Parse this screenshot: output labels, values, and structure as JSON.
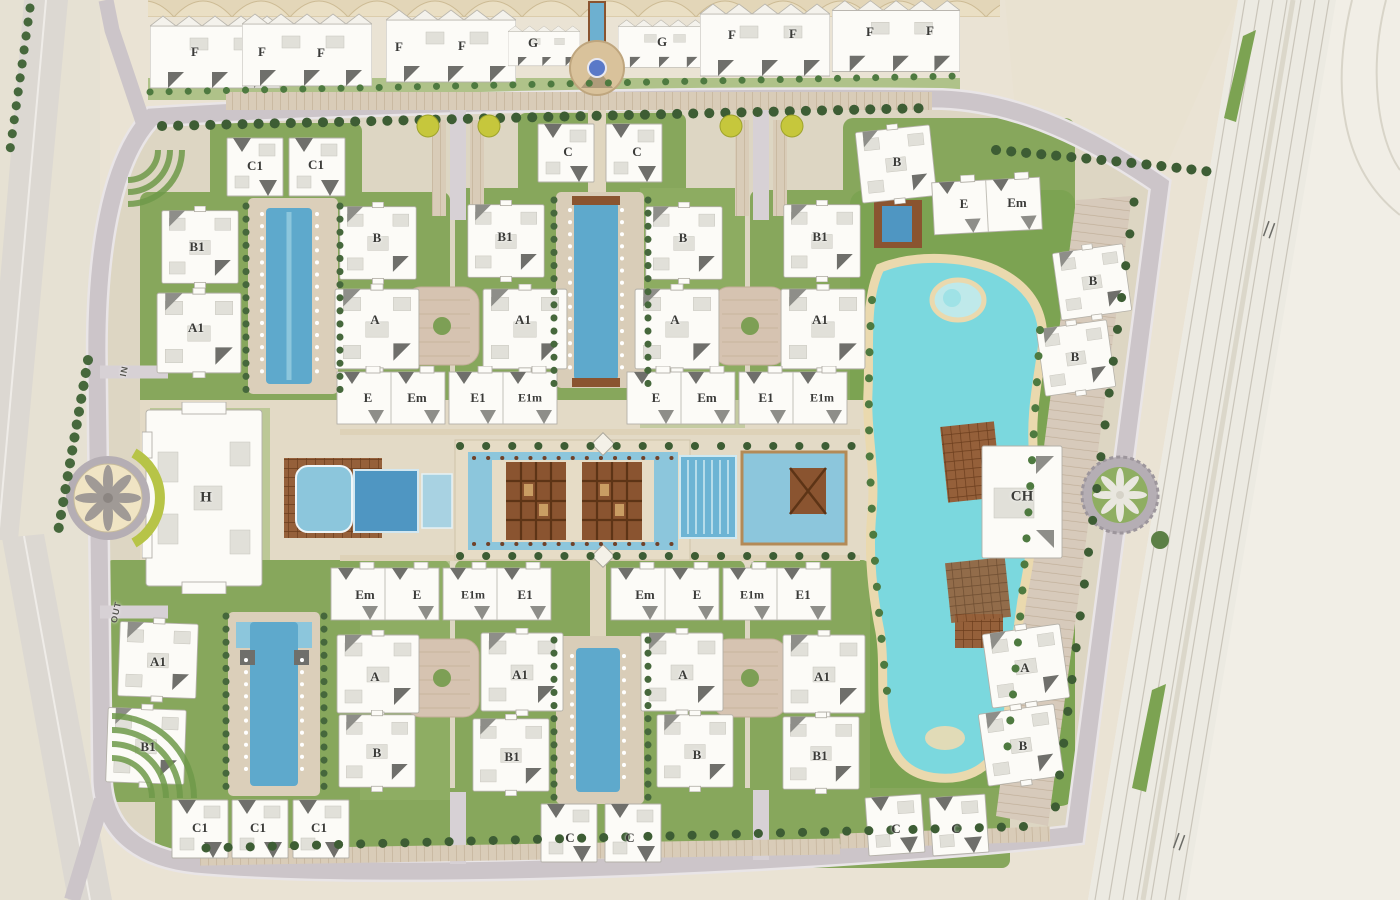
{
  "map": {
    "type": "residential-compound-master-plan",
    "building_labels": [
      {
        "text": "F",
        "x": 195,
        "y": 52
      },
      {
        "text": "F",
        "x": 262,
        "y": 52
      },
      {
        "text": "F",
        "x": 321,
        "y": 53
      },
      {
        "text": "F",
        "x": 399,
        "y": 47
      },
      {
        "text": "F",
        "x": 462,
        "y": 46
      },
      {
        "text": "G",
        "x": 533,
        "y": 43
      },
      {
        "text": "G",
        "x": 662,
        "y": 42
      },
      {
        "text": "F",
        "x": 732,
        "y": 35
      },
      {
        "text": "F",
        "x": 793,
        "y": 34
      },
      {
        "text": "F",
        "x": 870,
        "y": 32
      },
      {
        "text": "F",
        "x": 930,
        "y": 31
      },
      {
        "text": "C1",
        "x": 255,
        "y": 166
      },
      {
        "text": "C1",
        "x": 316,
        "y": 165
      },
      {
        "text": "C",
        "x": 568,
        "y": 152
      },
      {
        "text": "C",
        "x": 637,
        "y": 152
      },
      {
        "text": "B",
        "x": 897,
        "y": 162
      },
      {
        "text": "E",
        "x": 964,
        "y": 204
      },
      {
        "text": "Em",
        "x": 1017,
        "y": 203
      },
      {
        "text": "B1",
        "x": 197,
        "y": 247
      },
      {
        "text": "B",
        "x": 377,
        "y": 238
      },
      {
        "text": "B1",
        "x": 505,
        "y": 237
      },
      {
        "text": "B",
        "x": 683,
        "y": 238
      },
      {
        "text": "B1",
        "x": 820,
        "y": 237
      },
      {
        "text": "B",
        "x": 1093,
        "y": 281
      },
      {
        "text": "A1",
        "x": 196,
        "y": 328
      },
      {
        "text": "A",
        "x": 375,
        "y": 320
      },
      {
        "text": "A1",
        "x": 523,
        "y": 320
      },
      {
        "text": "A",
        "x": 675,
        "y": 320
      },
      {
        "text": "A1",
        "x": 820,
        "y": 320
      },
      {
        "text": "B",
        "x": 1075,
        "y": 357
      },
      {
        "text": "E",
        "x": 368,
        "y": 398
      },
      {
        "text": "Em",
        "x": 417,
        "y": 398
      },
      {
        "text": "E1",
        "x": 478,
        "y": 398
      },
      {
        "text": "E1m",
        "x": 530,
        "y": 398,
        "size": 12
      },
      {
        "text": "E",
        "x": 656,
        "y": 398
      },
      {
        "text": "Em",
        "x": 707,
        "y": 398
      },
      {
        "text": "E1",
        "x": 766,
        "y": 398
      },
      {
        "text": "E1m",
        "x": 822,
        "y": 398,
        "size": 12
      },
      {
        "text": "H",
        "x": 206,
        "y": 498,
        "size": 15
      },
      {
        "text": "CH",
        "x": 1022,
        "y": 497,
        "size": 15
      },
      {
        "text": "Em",
        "x": 365,
        "y": 595
      },
      {
        "text": "E",
        "x": 417,
        "y": 595
      },
      {
        "text": "E1m",
        "x": 473,
        "y": 595,
        "size": 12
      },
      {
        "text": "E1",
        "x": 525,
        "y": 595
      },
      {
        "text": "Em",
        "x": 645,
        "y": 595
      },
      {
        "text": "E",
        "x": 697,
        "y": 595
      },
      {
        "text": "E1m",
        "x": 752,
        "y": 595,
        "size": 12
      },
      {
        "text": "E1",
        "x": 803,
        "y": 595
      },
      {
        "text": "A1",
        "x": 158,
        "y": 662
      },
      {
        "text": "A",
        "x": 375,
        "y": 677
      },
      {
        "text": "A1",
        "x": 520,
        "y": 675
      },
      {
        "text": "A",
        "x": 683,
        "y": 675
      },
      {
        "text": "A1",
        "x": 822,
        "y": 677
      },
      {
        "text": "A",
        "x": 1025,
        "y": 668
      },
      {
        "text": "B1",
        "x": 148,
        "y": 747
      },
      {
        "text": "B",
        "x": 377,
        "y": 753
      },
      {
        "text": "B1",
        "x": 512,
        "y": 757
      },
      {
        "text": "B",
        "x": 697,
        "y": 755
      },
      {
        "text": "B1",
        "x": 820,
        "y": 756
      },
      {
        "text": "B",
        "x": 1023,
        "y": 746
      },
      {
        "text": "C1",
        "x": 200,
        "y": 828
      },
      {
        "text": "C1",
        "x": 258,
        "y": 828
      },
      {
        "text": "C1",
        "x": 319,
        "y": 828
      },
      {
        "text": "C",
        "x": 570,
        "y": 838
      },
      {
        "text": "C",
        "x": 630,
        "y": 838
      },
      {
        "text": "C",
        "x": 896,
        "y": 829
      },
      {
        "text": "C",
        "x": 956,
        "y": 829
      }
    ],
    "road_labels": [
      {
        "text": "IN",
        "x": 124,
        "y": 371,
        "rot": -78
      },
      {
        "text": "OUT",
        "x": 116,
        "y": 612,
        "rot": -78
      }
    ],
    "palette": {
      "terrain": "#eae3d4",
      "interior": "#ddd6c3",
      "ring_road": "#ccc5c9",
      "highway": "#eceae2",
      "lawn": "#87a75c",
      "tree": "#3d5d34",
      "lake": "#7bd8de",
      "pool": "#5ea9cc",
      "pool_light": "#8cc6dc",
      "sand": "#ead9ae",
      "deck_brown": "#95603a",
      "parking_tan": "#d9ccb8",
      "building": "#fcfbf7",
      "roof_dark": "#6f6f6b",
      "canopy": "#eadfc4",
      "flowerbed_yellow": "#c6c73c"
    }
  }
}
